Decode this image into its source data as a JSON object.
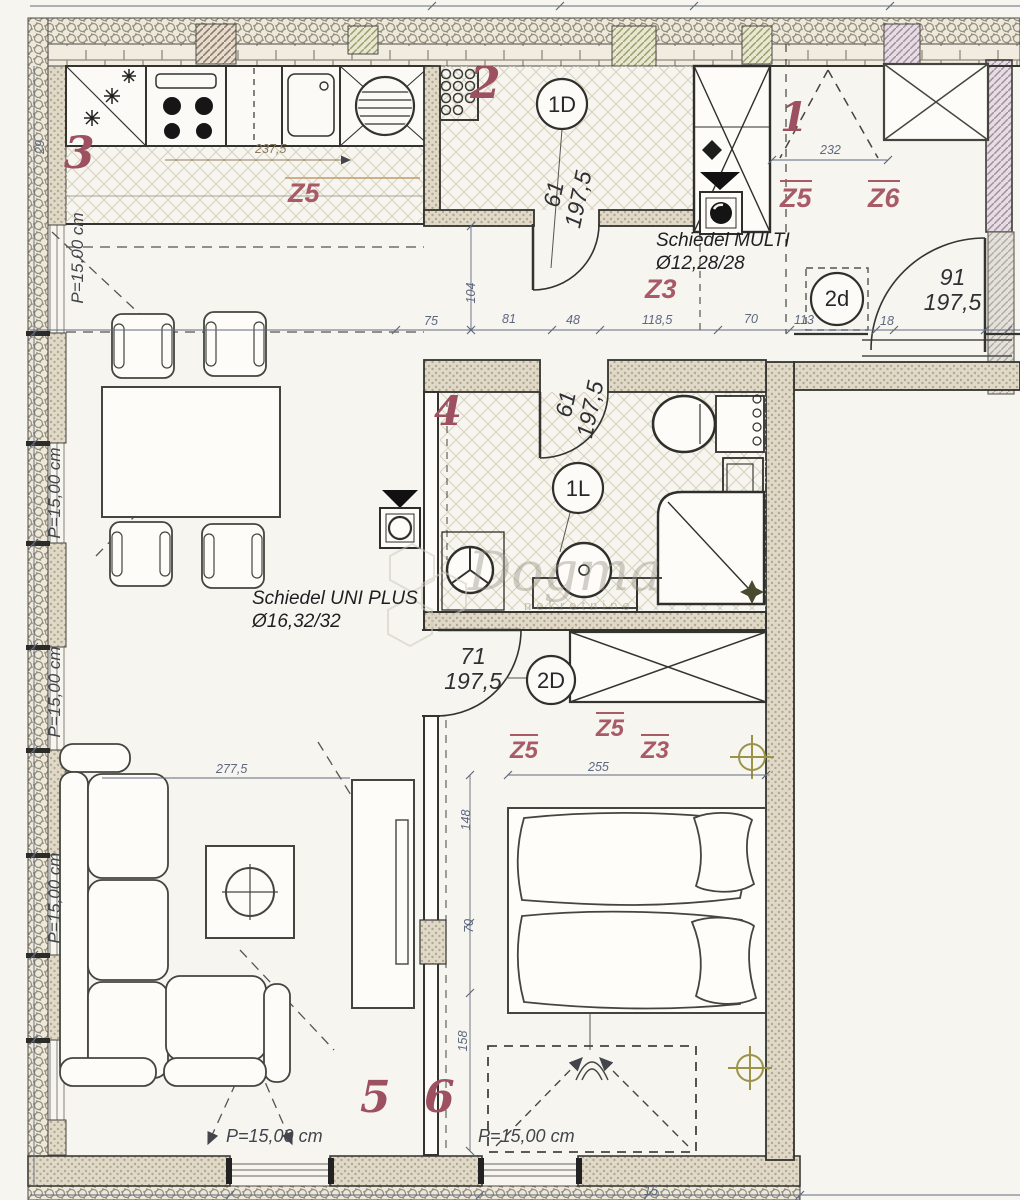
{
  "plan": {
    "watermark": {
      "brand": "Dogma",
      "tagline": "nekretnine"
    },
    "room_numbers": {
      "r1": "1",
      "r2": "2",
      "r3": "3",
      "r4": "4",
      "r5": "5",
      "r6": "6"
    },
    "door_tags": {
      "hall": "1D",
      "room1": "2d",
      "bath": "1L",
      "bedroom": "2D"
    },
    "door_sizes": {
      "hall_w": "61",
      "hall_h": "197,5",
      "bath_w": "61",
      "bath_h": "197,5",
      "room1_w": "91",
      "room1_h": "197,5",
      "bedroom_w": "71",
      "bedroom_h": "197,5"
    },
    "zones": {
      "kitchen": "Z5",
      "hall": "Z3",
      "room1_a": "Z5",
      "room1_b": "Z6",
      "bedroom_a": "Z5",
      "bedroom_b": "Z5",
      "bedroom_c": "Z3"
    },
    "chimneys": {
      "multi_name": "Schiedel MULTI",
      "multi_size": "Ø12,28/28",
      "uni_name": "Schiedel UNI PLUS",
      "uni_size": "Ø16,32/32"
    },
    "parapet_label": "P=15,00 cm",
    "dims": {
      "kitchen_run": "237,5",
      "left_v": "29",
      "hall_v": "104",
      "d75": "75",
      "d81": "81",
      "d48": "48",
      "d118": "118,5",
      "d70": "70",
      "d113": "113",
      "d18": "18",
      "room1_w": "232",
      "living_w": "277,5",
      "bed_w": "255",
      "bed_a": "148",
      "bed_b": "70",
      "bed_c": "158",
      "bottom": "15"
    }
  }
}
